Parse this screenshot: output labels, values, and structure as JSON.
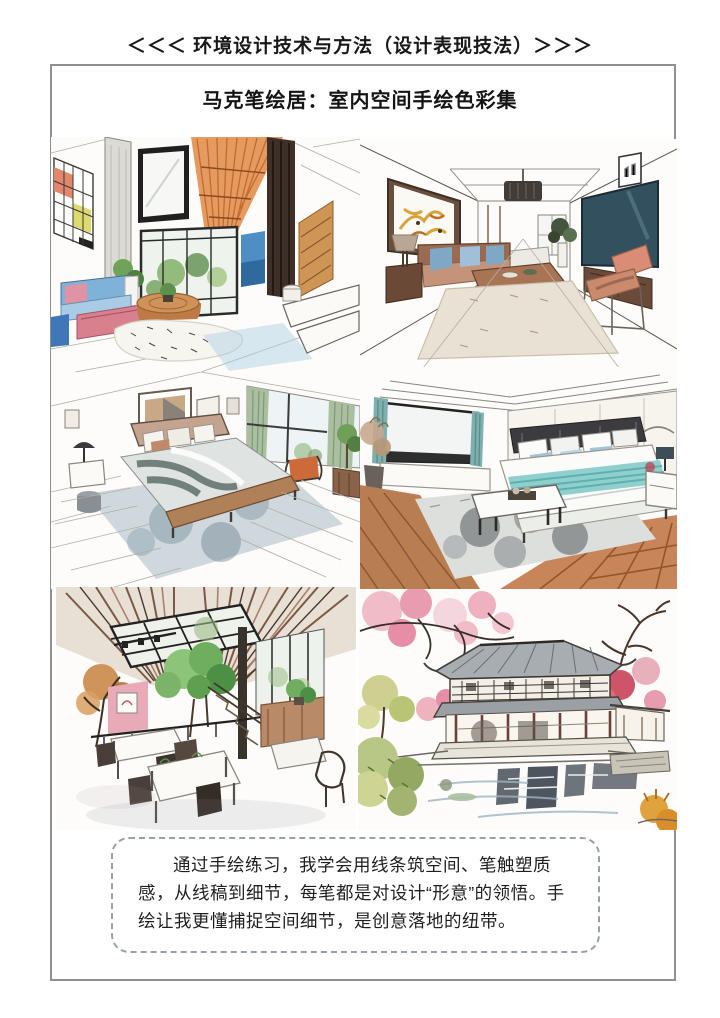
{
  "page": {
    "header": "＜＜＜ 环境设计技术与方法（设计表现技法）＞＞＞",
    "title": "马克笔绘居：室内空间手绘色彩集",
    "caption": "通过手绘练习，我学会用线条筑空间、笔触塑质感，从线稿到细节，每笔都是对设计“形意”的领悟。手绘让我更懂捕捉空间细节，是创意落地的纽带。"
  },
  "artworks": [
    {
      "name": "loft-living-room-sketch"
    },
    {
      "name": "one-point-living-room-sketch"
    },
    {
      "name": "gray-bedroom-sketch"
    },
    {
      "name": "teal-bedroom-sketch"
    },
    {
      "name": "loft-cafe-sketch"
    },
    {
      "name": "garden-pavilion-sketch"
    }
  ],
  "colors": {
    "frame_border": "#8f8f8f",
    "caption_border": "#97a0a8",
    "text": "#1c1c1c",
    "mondrian_red": "#e2876a",
    "mondrian_yellow": "#ddda6e",
    "accent_blue": "#4d8fc4",
    "sofa_pink": "#d9808f",
    "wood": "#c98a5a",
    "tv_navy": "#33505e",
    "bedding_teal": "#8fd0cf",
    "curtain_green": "#aabfa0",
    "floor_wood": "#c9855a",
    "blossom_pink": "#eeb3c0",
    "roof_gray": "#a8adb2"
  }
}
